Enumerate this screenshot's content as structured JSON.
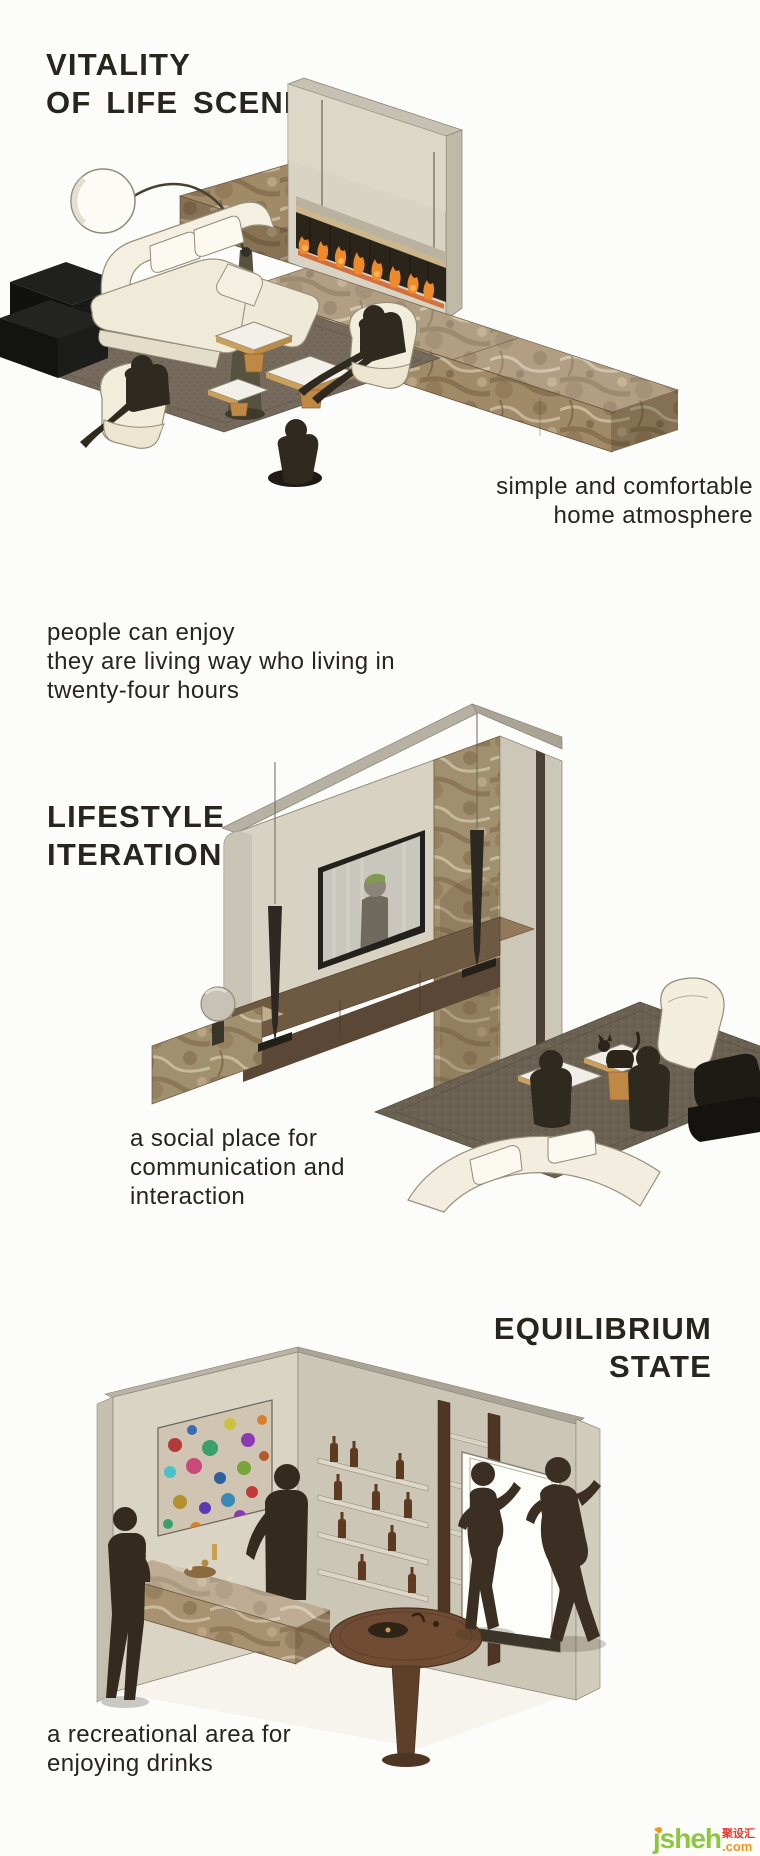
{
  "palette": {
    "background": "#fcfcfa",
    "ink": "#27251d",
    "beige_wall": "#d8d2c2",
    "marble_brown": "#a18a68",
    "flame_orange": "#ed8a2c",
    "silhouette": "#32291d",
    "cream_upholstery": "#f2ecdc",
    "wood": "#c08845",
    "rug": "#756a5c"
  },
  "sections": [
    {
      "name": "vitality-of-life-scene",
      "title_lines": [
        "VITALITY",
        "OF LIFE SCENE"
      ],
      "caption_lines": [
        "simple and comfortable",
        "home atmosphere"
      ],
      "scene": "isometric-living-room-with-fireplace"
    },
    {
      "name": "lifestyle-iteration",
      "intro_lines": [
        "people can enjoy",
        "they are living way who living in",
        "twenty-four hours"
      ],
      "title_lines": [
        "LIFESTYLE",
        "ITERATION"
      ],
      "caption_lines": [
        "a social place for",
        "communication and",
        "interaction"
      ],
      "scene": "isometric-tv-wall-lounge"
    },
    {
      "name": "equilibrium-state",
      "title_lines": [
        "EQUILIBRIUM",
        "STATE"
      ],
      "caption_lines": [
        "a recreational area for",
        "enjoying drinks"
      ],
      "scene": "isometric-home-bar"
    }
  ],
  "watermark": {
    "brand": "jsheh",
    "cn": "聚设汇",
    "tld": ".com",
    "green": "#8dc63f",
    "orange": "#f7941d",
    "red": "#e8392e"
  }
}
